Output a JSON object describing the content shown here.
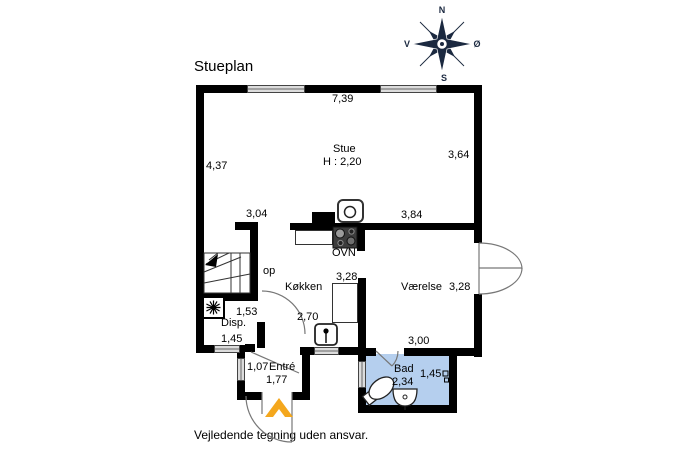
{
  "title": "Stueplan",
  "footer": "Vejledende tegning uden ansvar.",
  "compass": {
    "north": "N",
    "east": "Ø",
    "south": "S",
    "west": "V"
  },
  "rooms": {
    "stue": {
      "label": "Stue",
      "height": "H : 2,20"
    },
    "kokken": {
      "label": "Køkken"
    },
    "vaerelse": {
      "label": "Værelse"
    },
    "bad": {
      "label": "Bad"
    },
    "entre": {
      "label": "Entré"
    },
    "disp": {
      "label": "Disp."
    }
  },
  "labels": {
    "oven": "OVN",
    "stairs_up": "op"
  },
  "dims": {
    "stue_width": "7,39",
    "stue_left": "4,37",
    "stue_right": "3,64",
    "stair_top": "3,04",
    "mid_wall": "3,84",
    "kokken_depth": "3,28",
    "vaerelse_depth": "3,28",
    "kokken_width": "2,70",
    "disp_width": "1,53",
    "disp_bottom": "1,45",
    "vaerelse_width": "3,00",
    "entre_left": "1,07",
    "entre_width": "1,77",
    "bad_width": "2,34",
    "bad_depth": "1,45"
  },
  "colors": {
    "wall": "#000000",
    "bath_fill": "#b5cfee",
    "window_fill": "#dcdcdc",
    "door_arc": "#777777",
    "entrance_chevron": "#f4a71d",
    "compass": "#1b2940"
  }
}
